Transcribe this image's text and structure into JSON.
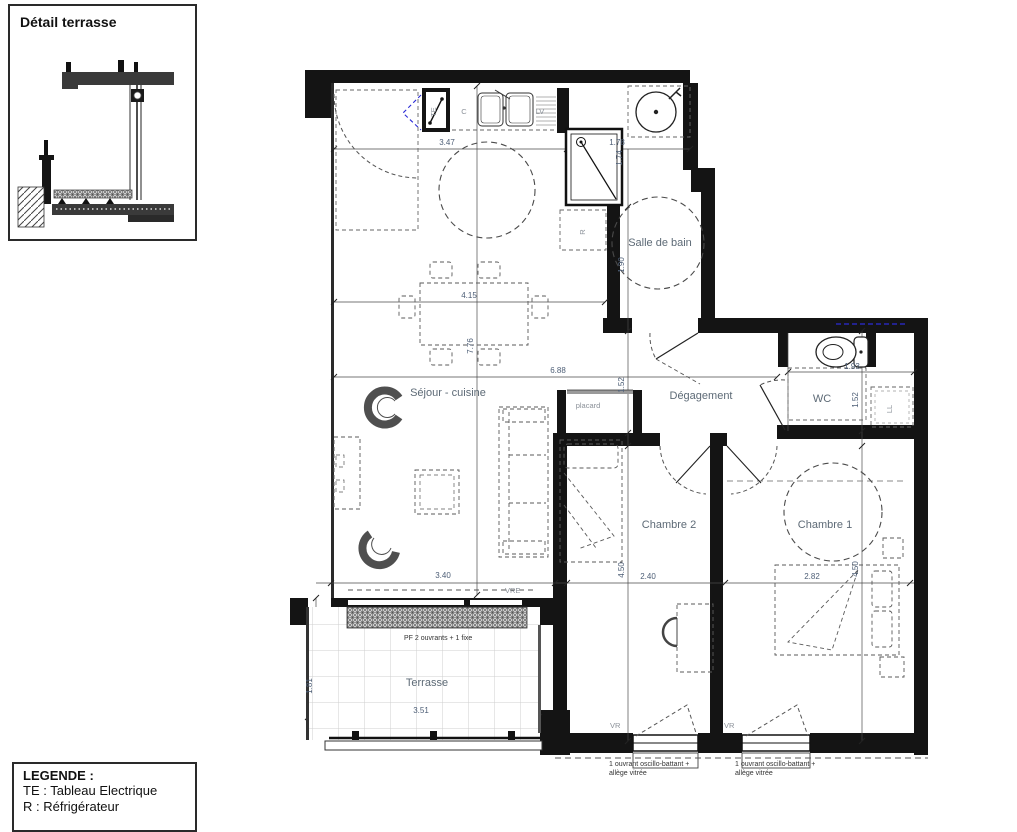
{
  "detail_panel": {
    "title": "Détail terrasse"
  },
  "legend_panel": {
    "title": "LEGENDE :",
    "item_te": "TE : Tableau Electrique",
    "item_r": "R : Réfrigérateur"
  },
  "rooms": {
    "sejour_cuisine": "Séjour - cuisine",
    "salle_de_bain": "Salle de bain",
    "degagement": "Dégagement",
    "wc": "WC",
    "chambre_2": "Chambre 2",
    "chambre_1": "Chambre 1",
    "terrasse": "Terrasse",
    "placard": "placard"
  },
  "fixtures": {
    "tableau_electrique": "TE",
    "cuisson": "C",
    "lave_vaisselle": "LV",
    "refrigerateur": "R",
    "lave_linge": "LL"
  },
  "openings": {
    "vre": "VRE",
    "vr_chambre_2": "VR",
    "vr_chambre_1": "VR",
    "pf_terrasse": "PF 2 ouvrants + 1 fixe",
    "note_line_1": "1 ouvrant oscillo-battant +",
    "note_line_2": "allège vitrée"
  },
  "dims": {
    "kitchen_width": "3.47",
    "bath_niche_width": "1.78",
    "bath_niche_depth": "1.74",
    "sejour_width": "4.15",
    "sejour_depth": "7.76",
    "sejour_total_width": "6.88",
    "bath_width": "1.90",
    "hall_width": "1.52",
    "wc_width": "1.93",
    "wc_depth": "1.52",
    "bay_width": "3.40",
    "chambre_2_width": "2.40",
    "chambre_1_width": "2.82",
    "chambre_2_depth": "4.50",
    "chambre_1_depth": "4.50",
    "terrasse_depth": "1.81",
    "terrasse_width": "3.51"
  }
}
